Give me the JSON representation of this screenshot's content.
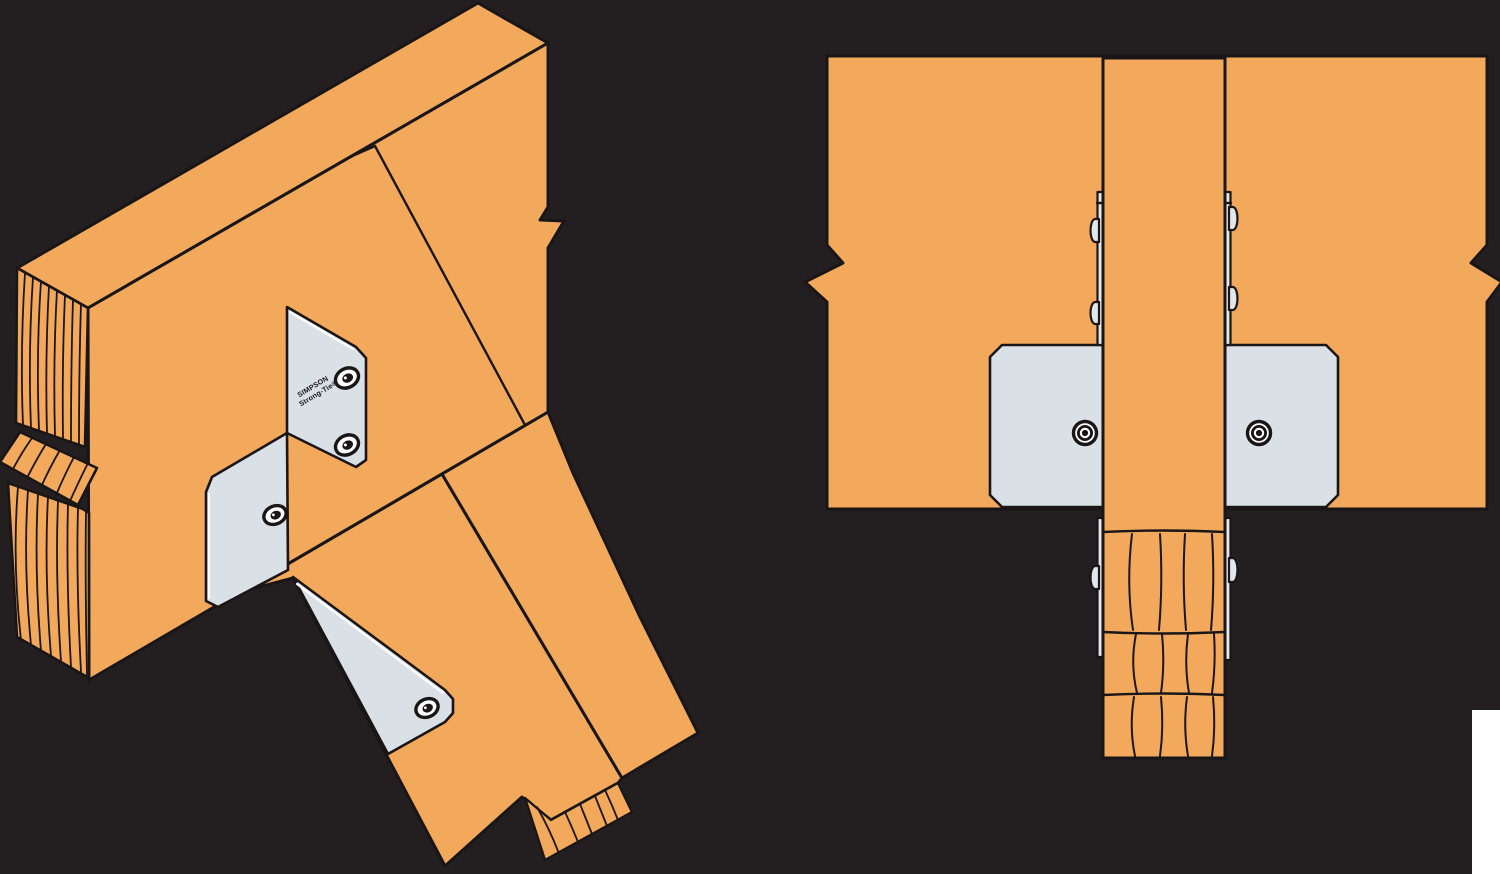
{
  "brand_plate": {
    "line1": "SIMPSON",
    "line2": "Strong-Tie®"
  },
  "colors": {
    "background": "#231F20",
    "wood": "#F2A95C",
    "outline": "#1A1617",
    "metal_plate": "#D9E0E6",
    "metal_edge": "#E2E7EA",
    "highlight": "#FFFFFF"
  },
  "views": {
    "left_isometric": {
      "plate_count": 3,
      "bolt_count": 4
    },
    "right_front": {
      "face_plate_bolt_count": 2,
      "side_tab_bolt_count": 6
    }
  }
}
